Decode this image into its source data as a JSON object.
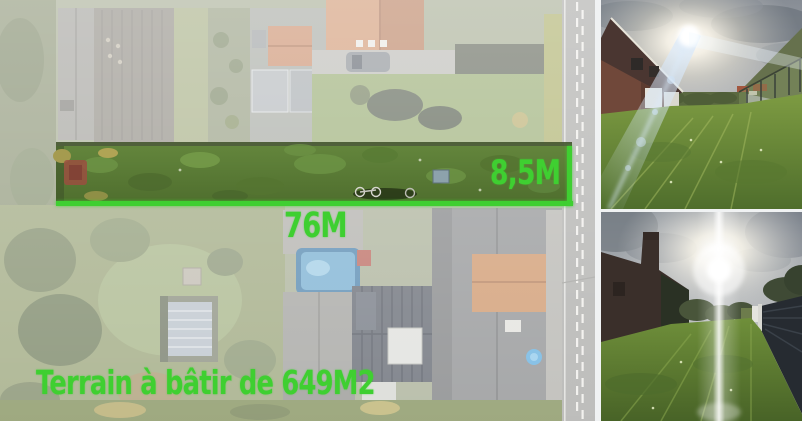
{
  "overlay": {
    "accent_color": "#3fcf31",
    "width_label": "8,5M",
    "length_label": "76M",
    "area_label": "Terrain à bâtir de 649M2"
  }
}
